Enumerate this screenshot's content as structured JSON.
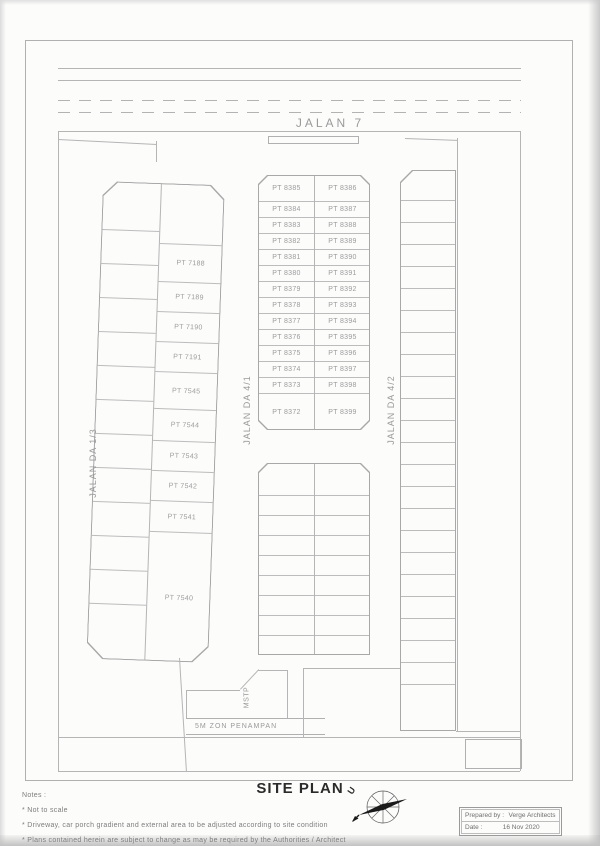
{
  "plan": {
    "road_top_label": "JALAN 7",
    "streets": {
      "left": "JALAN DA 1/3",
      "mid": "JALAN DA 4/1",
      "right": "JALAN DA 4/2"
    },
    "mstp_label": "MSTP",
    "buffer_label": "5M ZON PENAMPAN",
    "strips": {
      "left_block": {
        "columns": [
          {
            "w": 57,
            "cells": [
              {
                "h": 48,
                "label": null
              },
              {
                "h": 34,
                "label": null
              },
              {
                "h": 34,
                "label": null
              },
              {
                "h": 34,
                "label": null
              },
              {
                "h": 34,
                "label": null
              },
              {
                "h": 34,
                "label": null
              },
              {
                "h": 34,
                "label": null
              },
              {
                "h": 34,
                "label": null
              },
              {
                "h": 34,
                "label": null
              },
              {
                "h": 34,
                "label": null
              },
              {
                "h": 34,
                "label": null
              },
              {
                "h": 34,
                "label": null
              },
              {
                "h": 56,
                "label": null
              }
            ]
          },
          {
            "w": 63,
            "cells": [
              {
                "h": 60,
                "label": null
              },
              {
                "h": 38,
                "label": "PT 7188"
              },
              {
                "h": 30,
                "label": "PT 7189"
              },
              {
                "h": 30,
                "label": "PT 7190"
              },
              {
                "h": 30,
                "label": "PT 7191"
              },
              {
                "h": 37,
                "label": "PT 7545"
              },
              {
                "h": 32,
                "label": "PT 7544"
              },
              {
                "h": 30,
                "label": "PT 7543"
              },
              {
                "h": 30,
                "label": "PT 7542"
              },
              {
                "h": 31,
                "label": "PT 7541"
              },
              {
                "h": 130,
                "label": "PT 7540"
              }
            ]
          }
        ]
      },
      "mid_block": {
        "columns": [
          {
            "w": 55,
            "cells": [
              {
                "h": 26,
                "label": "PT 8385"
              },
              {
                "h": 16,
                "label": "PT 8384"
              },
              {
                "h": 16,
                "label": "PT 8383"
              },
              {
                "h": 16,
                "label": "PT 8382"
              },
              {
                "h": 16,
                "label": "PT 8381"
              },
              {
                "h": 16,
                "label": "PT 8380"
              },
              {
                "h": 16,
                "label": "PT 8379"
              },
              {
                "h": 16,
                "label": "PT 8378"
              },
              {
                "h": 16,
                "label": "PT 8377"
              },
              {
                "h": 16,
                "label": "PT 8376"
              },
              {
                "h": 16,
                "label": "PT 8375"
              },
              {
                "h": 16,
                "label": "PT 8374"
              },
              {
                "h": 16,
                "label": "PT 8373"
              },
              {
                "h": 37,
                "label": "PT 8372"
              }
            ]
          },
          {
            "w": 55,
            "cells": [
              {
                "h": 26,
                "label": "PT 8386"
              },
              {
                "h": 16,
                "label": "PT 8387"
              },
              {
                "h": 16,
                "label": "PT 8388"
              },
              {
                "h": 16,
                "label": "PT 8389"
              },
              {
                "h": 16,
                "label": "PT 8390"
              },
              {
                "h": 16,
                "label": "PT 8391"
              },
              {
                "h": 16,
                "label": "PT 8392"
              },
              {
                "h": 16,
                "label": "PT 8393"
              },
              {
                "h": 16,
                "label": "PT 8394"
              },
              {
                "h": 16,
                "label": "PT 8395"
              },
              {
                "h": 16,
                "label": "PT 8396"
              },
              {
                "h": 16,
                "label": "PT 8397"
              },
              {
                "h": 16,
                "label": "PT 8398"
              },
              {
                "h": 37,
                "label": "PT 8399"
              }
            ]
          }
        ]
      },
      "lower_block": {
        "columns": [
          {
            "w": 55,
            "cells": [
              {
                "h": 32,
                "label": null
              },
              {
                "h": 20,
                "label": null
              },
              {
                "h": 20,
                "label": null
              },
              {
                "h": 20,
                "label": null
              },
              {
                "h": 20,
                "label": null
              },
              {
                "h": 20,
                "label": null
              },
              {
                "h": 20,
                "label": null
              },
              {
                "h": 20,
                "label": null
              },
              {
                "h": 20,
                "label": null
              }
            ]
          },
          {
            "w": 55,
            "cells": [
              {
                "h": 32,
                "label": null
              },
              {
                "h": 20,
                "label": null
              },
              {
                "h": 20,
                "label": null
              },
              {
                "h": 20,
                "label": null
              },
              {
                "h": 20,
                "label": null
              },
              {
                "h": 20,
                "label": null
              },
              {
                "h": 20,
                "label": null
              },
              {
                "h": 20,
                "label": null
              },
              {
                "h": 20,
                "label": null
              }
            ]
          }
        ]
      },
      "right_block": {
        "columns": [
          {
            "w": 55,
            "cells": [
              {
                "h": 30,
                "label": null
              },
              {
                "h": 22,
                "label": null
              },
              {
                "h": 22,
                "label": null
              },
              {
                "h": 22,
                "label": null
              },
              {
                "h": 22,
                "label": null
              },
              {
                "h": 22,
                "label": null
              },
              {
                "h": 22,
                "label": null
              },
              {
                "h": 22,
                "label": null
              },
              {
                "h": 22,
                "label": null
              },
              {
                "h": 22,
                "label": null
              },
              {
                "h": 22,
                "label": null
              },
              {
                "h": 22,
                "label": null
              },
              {
                "h": 22,
                "label": null
              },
              {
                "h": 22,
                "label": null
              },
              {
                "h": 22,
                "label": null
              },
              {
                "h": 22,
                "label": null
              },
              {
                "h": 22,
                "label": null
              },
              {
                "h": 22,
                "label": null
              },
              {
                "h": 22,
                "label": null
              },
              {
                "h": 22,
                "label": null
              },
              {
                "h": 22,
                "label": null
              },
              {
                "h": 22,
                "label": null
              },
              {
                "h": 22,
                "label": null
              },
              {
                "h": 47,
                "label": null
              }
            ]
          }
        ]
      }
    }
  },
  "footer": {
    "title": "SITE PLAN",
    "notes_heading": "Notes :",
    "notes": [
      "* Not to scale",
      "* Driveway, car porch gradient and external area to be adjusted according to site condition",
      "* Plans contained herein are subject to change as may be required by the Authorities / Architect"
    ],
    "compass_north": "U",
    "titleblock": {
      "prepared_label": "Prepared by :",
      "prepared_value": "Verge Architects",
      "date_label": "Date :",
      "date_value": "16 Nov 2020"
    }
  },
  "colors": {
    "line": "#b5b5b5",
    "text": "#8f8f8f",
    "title": "#2b2b2b",
    "needle": "#1a1a1a"
  }
}
